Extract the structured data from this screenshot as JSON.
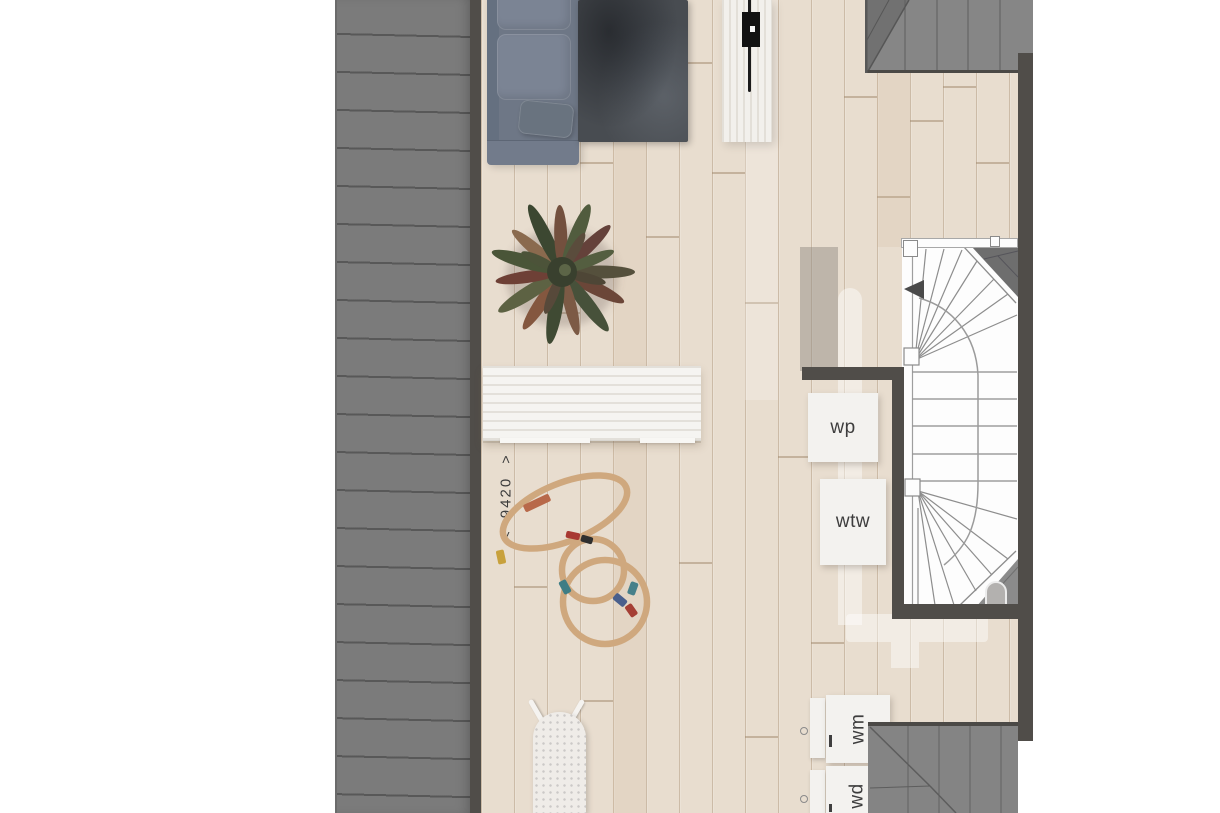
{
  "plan": {
    "type": "floor-plan-top-view",
    "dimension": {
      "arrow_left": "<",
      "value": "9420",
      "arrow_right": ">"
    },
    "labels": {
      "heat_pump": "wp",
      "heat_recovery_unit": "wtw",
      "washing_machine": "wm",
      "dryer": "wd"
    },
    "colors": {
      "deck": "#7b7b7b",
      "wall": "#504d49",
      "floor": "#e8ddcf",
      "roof": "#848484",
      "stair_background": "#fdfdfd",
      "label_text": "#3d3d3d",
      "track_wood": "#cfa87e"
    }
  }
}
